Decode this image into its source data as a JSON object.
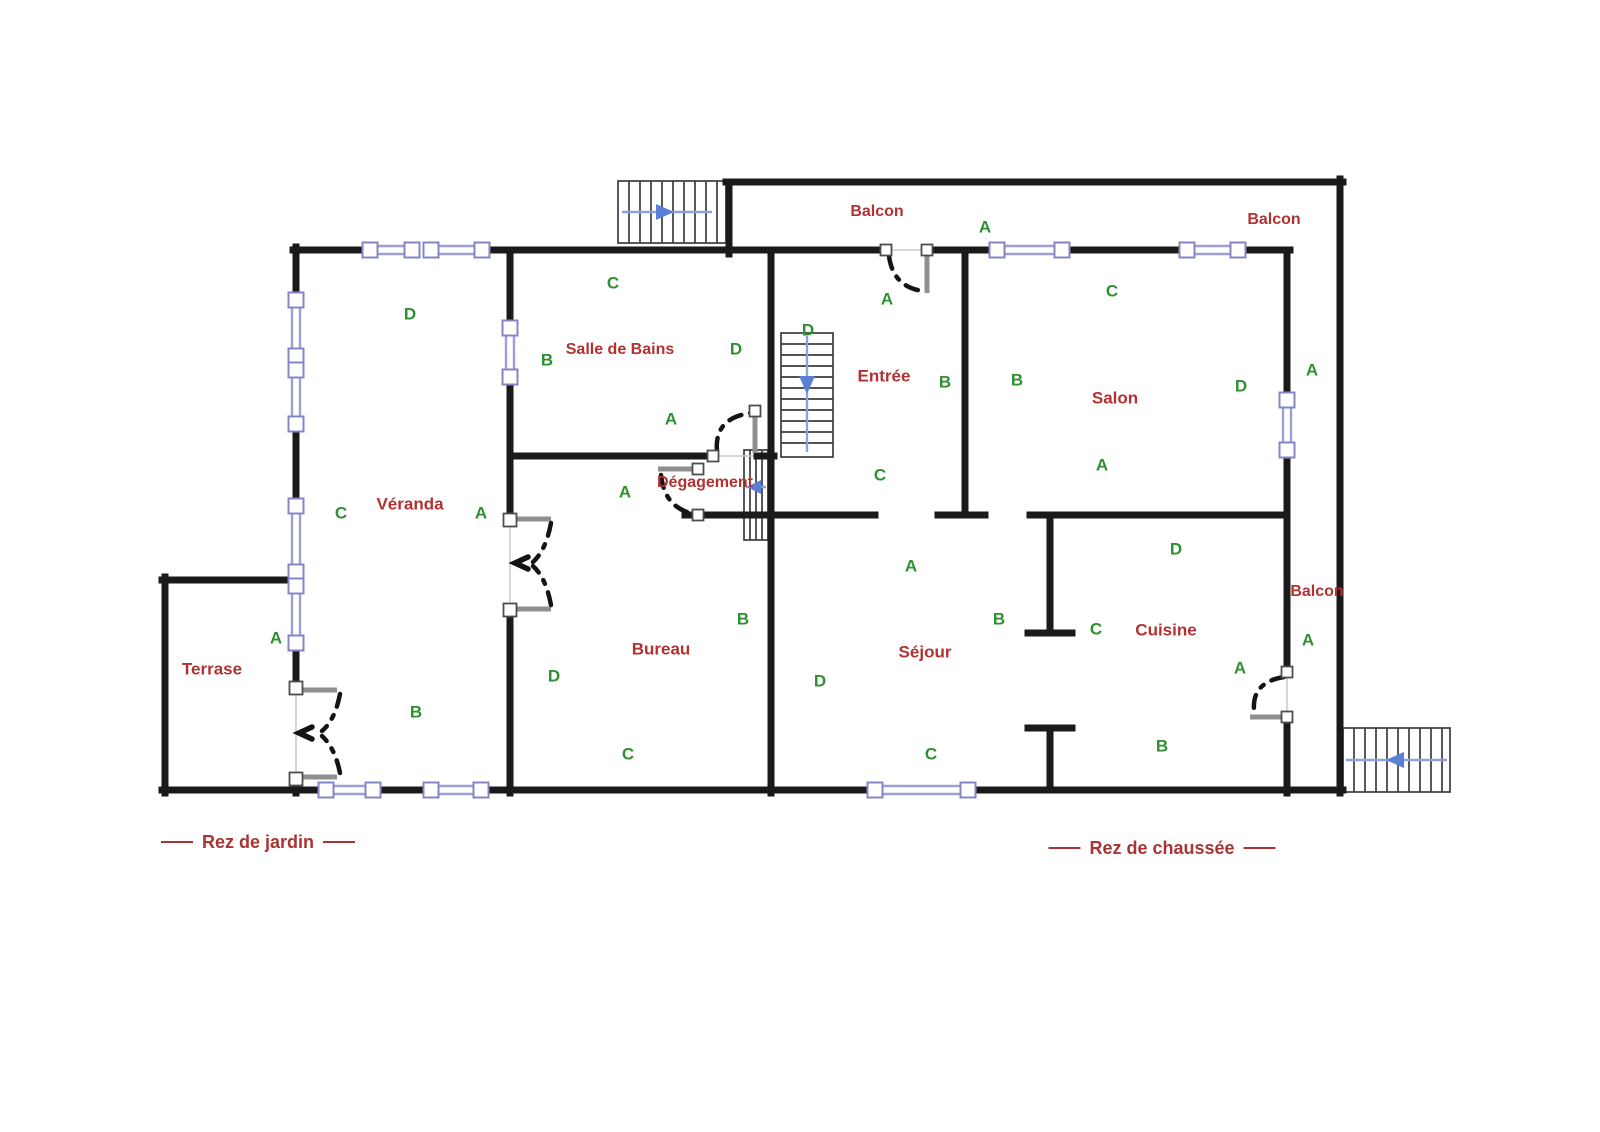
{
  "floor_labels": {
    "garden": "Rez de jardin",
    "ground": "Rez de chaussée"
  },
  "room_labels": {
    "terrase": "Terrase",
    "veranda": "Véranda",
    "salle_de_bains": "Salle de Bains",
    "degagement": "Dégagement",
    "bureau": "Bureau",
    "entree": "Entrée",
    "salon": "Salon",
    "sejour": "Séjour",
    "cuisine": "Cuisine"
  },
  "balcony_labels": {
    "top": "Balcon",
    "top_right": "Balcon",
    "right": "Balcon"
  },
  "letters": [
    "D",
    "C",
    "A",
    "B",
    "A",
    "C",
    "B",
    "D",
    "A",
    "A",
    "B",
    "D",
    "C",
    "A",
    "D",
    "B",
    "C",
    "A",
    "C",
    "B",
    "D",
    "A",
    "A",
    "A",
    "D",
    "B",
    "C",
    "D",
    "C",
    "B",
    "A",
    "A"
  ],
  "colors": {
    "wall": "#1a1a1a",
    "room_label": "#b23232",
    "letter_label": "#2f9032",
    "floor_label": "#a93434",
    "window_line": "#9f9fd8",
    "window_frame": "#8585c4",
    "door_leaf": "#8f8f8f",
    "stair_line": "#3c3c3c",
    "stair_arrow": "#5b7fd4"
  }
}
